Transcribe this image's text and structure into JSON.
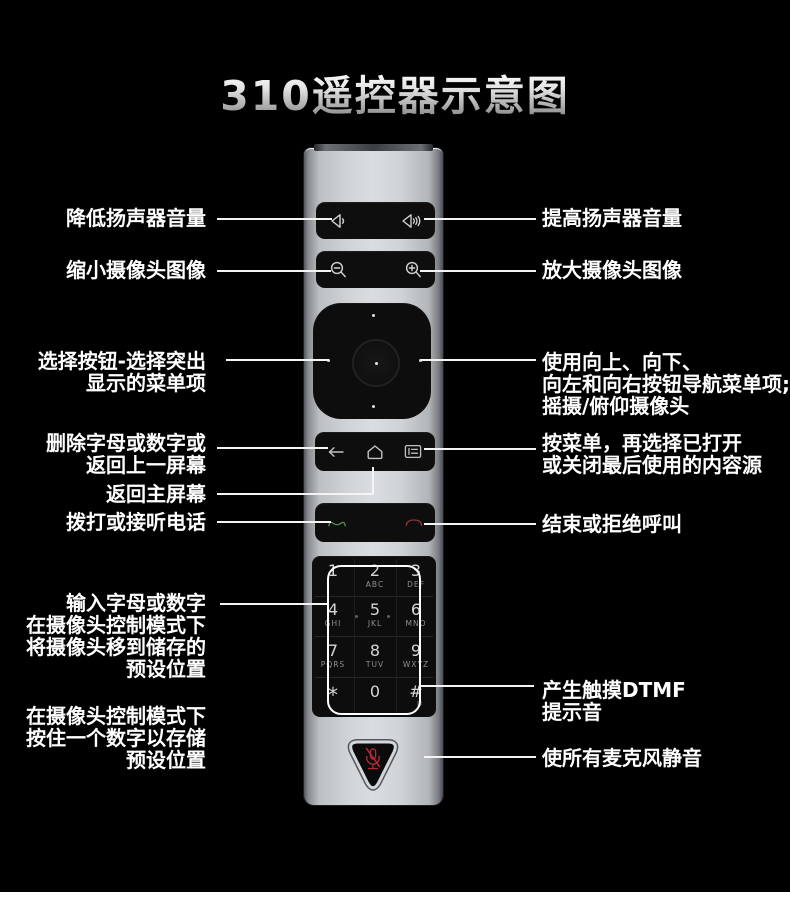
{
  "title": {
    "text": "310遥控器示意图"
  },
  "colors": {
    "background": "#000000",
    "label_text": "#ffffff",
    "title_silver_top": "#ffffff",
    "title_silver_bottom": "#8d8d8d",
    "remote_silver": "#d0d4d7",
    "button_black": "#0e0e0e",
    "highlight_box": "#ffffff",
    "call_green": "#4a8f52",
    "call_red": "#93323c",
    "mute_mic_red": "#ad2a36",
    "footer_strip": "#ffffff"
  },
  "keypad": {
    "registered_mark": "®",
    "keys": [
      {
        "num": "1",
        "letters": ""
      },
      {
        "num": "2",
        "letters": "ABC"
      },
      {
        "num": "3",
        "letters": "DEF"
      },
      {
        "num": "4",
        "letters": "GHI"
      },
      {
        "num": "5",
        "letters": "JKL"
      },
      {
        "num": "6",
        "letters": "MNO"
      },
      {
        "num": "7",
        "letters": "PQRS"
      },
      {
        "num": "8",
        "letters": "TUV"
      },
      {
        "num": "9",
        "letters": "WXYZ"
      },
      {
        "num": "*",
        "letters": ""
      },
      {
        "num": "0",
        "letters": ""
      },
      {
        "num": "#",
        "letters": ""
      }
    ]
  },
  "annotations": {
    "left": [
      {
        "id": "volume-down",
        "lines": [
          "降低扬声器音量"
        ]
      },
      {
        "id": "zoom-out",
        "lines": [
          "缩小摄像头图像"
        ]
      },
      {
        "id": "select",
        "lines": [
          "选择按钮-选择突出",
          "显示的菜单项"
        ]
      },
      {
        "id": "delete-back",
        "lines": [
          "删除字母或数字或",
          "返回上一屏幕"
        ]
      },
      {
        "id": "home",
        "lines": [
          "返回主屏幕"
        ]
      },
      {
        "id": "call",
        "lines": [
          "拨打或接听电话"
        ]
      },
      {
        "id": "keypad-input",
        "lines": [
          "输入字母或数字",
          "在摄像头控制模式下",
          "将摄像头移到储存的",
          "预设位置"
        ]
      },
      {
        "id": "store-preset",
        "lines": [
          "在摄像头控制模式下",
          "按住一个数字以存储",
          "预设位置"
        ]
      }
    ],
    "right": [
      {
        "id": "volume-up",
        "lines": [
          "提高扬声器音量"
        ]
      },
      {
        "id": "zoom-in",
        "lines": [
          "放大摄像头图像"
        ]
      },
      {
        "id": "navigate",
        "lines": [
          "使用向上、向下、",
          "向左和向右按钮导航菜单项;",
          "摇摄/俯仰摄像头"
        ]
      },
      {
        "id": "menu",
        "lines": [
          "按菜单，再选择已打开",
          "或关闭最后使用的内容源"
        ]
      },
      {
        "id": "end-call",
        "lines": [
          "结束或拒绝呼叫"
        ]
      },
      {
        "id": "dtmf",
        "lines": [
          "产生触摸DTMF",
          "提示音"
        ]
      },
      {
        "id": "mute",
        "lines": [
          "使所有麦克风静音"
        ]
      }
    ]
  }
}
